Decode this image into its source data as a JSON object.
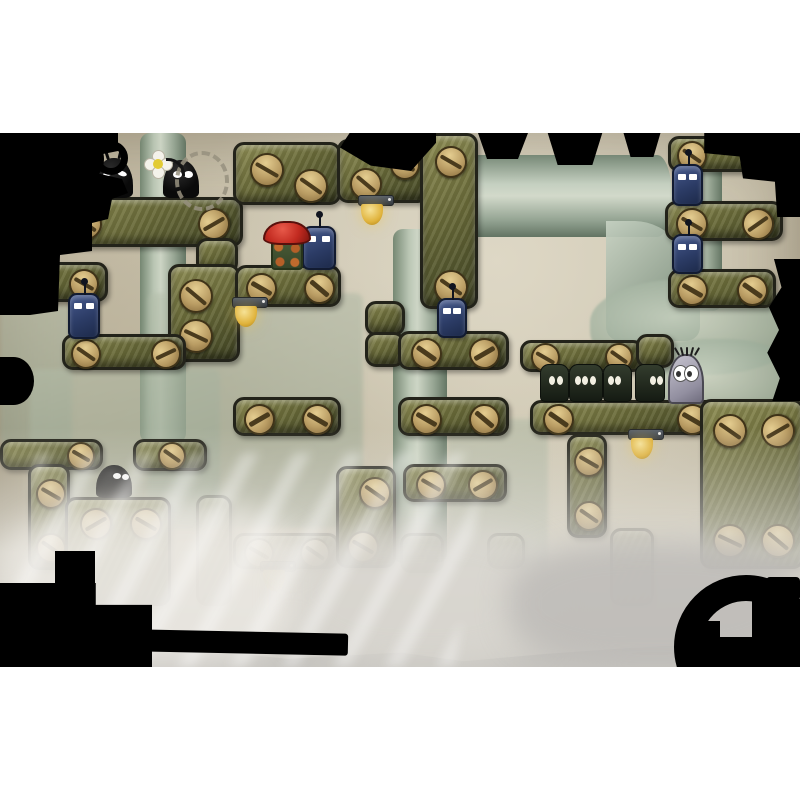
{
  "palette": {
    "paper": "#cbc3ae",
    "paper_light": "#d9d3c0",
    "paper_dark": "#b2a990",
    "plank": "#6b6c3a",
    "plank_border": "#23231a",
    "screw_brass": "#b99c63",
    "pipe": "#a3b1a2",
    "robot_blue": "#2c3c66",
    "creature_black": "#0b0b0b",
    "creature_green": "#222b20",
    "creature_gray": "#aaa7b4",
    "hero_cap_red": "#c52b24",
    "hero_body_green": "#41522f",
    "lamp_yellow": "#e3b93f",
    "ink_black": "#000000",
    "fog": "#e3e1da",
    "letterbox": "#ffffff"
  },
  "viewport": {
    "x": 0,
    "y": 133,
    "width": 800,
    "height": 534
  },
  "pipes": [
    {
      "kind": "v",
      "x": 140,
      "y": 0,
      "w": 46,
      "h": 310
    },
    {
      "kind": "v",
      "x": 393,
      "y": 96,
      "w": 54,
      "h": 334
    },
    {
      "kind": "v",
      "x": 676,
      "y": 28,
      "w": 46,
      "h": 150
    },
    {
      "kind": "h",
      "x": 452,
      "y": 22,
      "w": 220,
      "h": 82
    },
    {
      "kind": "elbow",
      "x": 606,
      "y": 88,
      "w": 94,
      "h": 120
    },
    {
      "kind": "bulge",
      "x": 590,
      "y": 146,
      "w": 210,
      "h": 96
    },
    {
      "kind": "bulge",
      "x": 636,
      "y": 206,
      "w": 164,
      "h": 86
    },
    {
      "kind": "panel",
      "x": 0,
      "y": 172,
      "w": 72,
      "h": 140
    },
    {
      "kind": "panel",
      "x": 30,
      "y": 236,
      "w": 190,
      "h": 160
    },
    {
      "kind": "panel",
      "x": 148,
      "y": 160,
      "w": 215,
      "h": 235
    },
    {
      "kind": "panel",
      "x": 448,
      "y": 286,
      "w": 100,
      "h": 150
    },
    {
      "kind": "collar",
      "x": 134,
      "y": 90,
      "w": 58,
      "h": 18
    },
    {
      "kind": "collar",
      "x": 444,
      "y": 16,
      "w": 20,
      "h": 94
    }
  ],
  "planks": [
    {
      "x": 55,
      "y": 64,
      "w": 182,
      "h": 44,
      "screws": [
        [
          12,
          8,
          28,
          35
        ],
        [
          140,
          8,
          28,
          -30
        ]
      ]
    },
    {
      "x": 196,
      "y": 105,
      "w": 36,
      "h": 30,
      "screws": []
    },
    {
      "x": 168,
      "y": 131,
      "w": 66,
      "h": 92,
      "screws": [
        [
          8,
          12,
          30,
          40
        ],
        [
          8,
          52,
          30,
          25
        ]
      ]
    },
    {
      "x": 233,
      "y": 9,
      "w": 102,
      "h": 57,
      "screws": [
        [
          14,
          8,
          30,
          30
        ],
        [
          58,
          24,
          30,
          35
        ]
      ]
    },
    {
      "x": 337,
      "y": 6,
      "w": 86,
      "h": 58,
      "screws": [
        [
          10,
          26,
          28,
          40
        ],
        [
          50,
          8,
          26,
          30
        ]
      ]
    },
    {
      "x": 420,
      "y": 0,
      "w": 52,
      "h": 170,
      "screws": [
        [
          12,
          10,
          28,
          30
        ],
        [
          11,
          134,
          30,
          35
        ]
      ]
    },
    {
      "x": 10,
      "y": 129,
      "w": 92,
      "h": 34,
      "screws": [
        [
          56,
          4,
          26,
          30
        ]
      ]
    },
    {
      "x": 62,
      "y": 201,
      "w": 118,
      "h": 30,
      "screws": [
        [
          6,
          2,
          26,
          35
        ],
        [
          86,
          2,
          26,
          -25
        ]
      ]
    },
    {
      "x": 235,
      "y": 132,
      "w": 100,
      "h": 36,
      "screws": [
        [
          8,
          5,
          27,
          30
        ],
        [
          66,
          5,
          27,
          40
        ]
      ]
    },
    {
      "x": 365,
      "y": 168,
      "w": 34,
      "h": 29,
      "screws": []
    },
    {
      "x": 365,
      "y": 199,
      "w": 34,
      "h": 29,
      "screws": []
    },
    {
      "x": 398,
      "y": 198,
      "w": 105,
      "h": 33,
      "screws": [
        [
          10,
          4,
          27,
          35
        ],
        [
          68,
          4,
          27,
          -30
        ]
      ]
    },
    {
      "x": 398,
      "y": 264,
      "w": 105,
      "h": 33,
      "screws": [
        [
          10,
          4,
          27,
          30
        ],
        [
          68,
          4,
          27,
          40
        ]
      ]
    },
    {
      "x": 233,
      "y": 264,
      "w": 102,
      "h": 33,
      "screws": [
        [
          8,
          4,
          27,
          -30
        ],
        [
          66,
          4,
          27,
          30
        ]
      ]
    },
    {
      "x": 530,
      "y": 267,
      "w": 182,
      "h": 29,
      "screws": [
        [
          10,
          1,
          27,
          35
        ],
        [
          144,
          1,
          27,
          30
        ]
      ]
    },
    {
      "x": 520,
      "y": 207,
      "w": 118,
      "h": 26,
      "screws": [
        [
          8,
          0,
          25,
          30
        ],
        [
          82,
          0,
          24,
          35
        ]
      ]
    },
    {
      "x": 636,
      "y": 201,
      "w": 32,
      "h": 28,
      "screws": []
    },
    {
      "x": 668,
      "y": 3,
      "w": 112,
      "h": 30,
      "screws": [
        [
          6,
          2,
          26,
          35
        ]
      ]
    },
    {
      "x": 665,
      "y": 68,
      "w": 112,
      "h": 34,
      "screws": [
        [
          8,
          4,
          28,
          30
        ],
        [
          74,
          4,
          28,
          -35
        ]
      ]
    },
    {
      "x": 668,
      "y": 136,
      "w": 102,
      "h": 33,
      "screws": [
        [
          6,
          3,
          27,
          30
        ],
        [
          66,
          3,
          27,
          35
        ]
      ]
    },
    {
      "x": 700,
      "y": 266,
      "w": 98,
      "h": 164,
      "screws": [
        [
          10,
          12,
          30,
          35
        ],
        [
          58,
          12,
          30,
          -30
        ],
        [
          10,
          122,
          30,
          25
        ],
        [
          58,
          122,
          30,
          40
        ]
      ]
    },
    {
      "x": 0,
      "y": 306,
      "w": 97,
      "h": 25,
      "screws": [
        [
          64,
          0,
          24,
          30
        ]
      ]
    },
    {
      "x": 133,
      "y": 306,
      "w": 68,
      "h": 26,
      "screws": [
        [
          22,
          0,
          24,
          35
        ]
      ]
    },
    {
      "x": 28,
      "y": 331,
      "w": 36,
      "h": 100,
      "screws": [
        [
          5,
          12,
          26,
          30
        ],
        [
          5,
          66,
          26,
          35
        ]
      ]
    },
    {
      "x": 65,
      "y": 364,
      "w": 100,
      "h": 103,
      "screws": [
        [
          12,
          8,
          28,
          -30
        ],
        [
          62,
          8,
          28,
          30
        ]
      ]
    },
    {
      "x": 196,
      "y": 362,
      "w": 30,
      "h": 105,
      "screws": [],
      "faded": true
    },
    {
      "x": 233,
      "y": 400,
      "w": 100,
      "h": 30,
      "screws": [
        [
          8,
          2,
          26,
          30
        ],
        [
          64,
          2,
          26,
          35
        ]
      ],
      "faded": true
    },
    {
      "x": 336,
      "y": 333,
      "w": 54,
      "h": 96,
      "screws": [
        [
          20,
          8,
          28,
          35
        ],
        [
          8,
          62,
          28,
          30
        ]
      ]
    },
    {
      "x": 403,
      "y": 331,
      "w": 98,
      "h": 32,
      "screws": [
        [
          10,
          3,
          26,
          30
        ],
        [
          62,
          3,
          26,
          -30
        ]
      ]
    },
    {
      "x": 400,
      "y": 400,
      "w": 38,
      "h": 34,
      "screws": [],
      "faded": true
    },
    {
      "x": 487,
      "y": 400,
      "w": 32,
      "h": 30,
      "screws": [],
      "faded": true
    },
    {
      "x": 567,
      "y": 301,
      "w": 34,
      "h": 98,
      "screws": [
        [
          4,
          10,
          26,
          30
        ],
        [
          4,
          64,
          26,
          35
        ]
      ]
    },
    {
      "x": 610,
      "y": 395,
      "w": 38,
      "h": 72,
      "screws": [],
      "faded": true
    }
  ],
  "lamps": [
    {
      "x": 358,
      "y": 62
    },
    {
      "x": 232,
      "y": 164
    },
    {
      "x": 628,
      "y": 296
    },
    {
      "x": 260,
      "y": 428,
      "faded": true
    }
  ],
  "robots": [
    {
      "x": 302,
      "y": 93,
      "w": 30,
      "h": 40,
      "antenna": true
    },
    {
      "x": 68,
      "y": 160,
      "w": 28,
      "h": 42,
      "antenna": true
    },
    {
      "x": 437,
      "y": 165,
      "w": 26,
      "h": 36,
      "antenna": true
    },
    {
      "x": 672,
      "y": 31,
      "w": 27,
      "h": 38,
      "antenna": true
    },
    {
      "x": 672,
      "y": 101,
      "w": 27,
      "h": 36,
      "antenna": true
    }
  ],
  "creatures": [
    {
      "type": "blob",
      "x": 95,
      "y": 25,
      "w": 38,
      "h": 40,
      "eyes": [
        [
          8,
          13,
          10,
          5,
          -18
        ],
        [
          22,
          13,
          10,
          5,
          18
        ]
      ],
      "hairs": true
    },
    {
      "type": "blob",
      "x": 163,
      "y": 27,
      "w": 36,
      "h": 38,
      "eyes": [
        [
          10,
          11,
          9,
          7,
          0
        ],
        [
          21,
          11,
          9,
          7,
          0
        ]
      ],
      "flower": [
        -19,
        -10
      ],
      "ring": [
        12,
        -9,
        46,
        52
      ]
    },
    {
      "type": "blob",
      "x": 96,
      "y": 332,
      "w": 36,
      "h": 33,
      "eyes": [
        [
          17,
          8,
          8,
          6,
          0
        ],
        [
          26,
          9,
          7,
          6,
          0
        ]
      ]
    },
    {
      "type": "square",
      "x": 540,
      "y": 231,
      "w": 27,
      "h": 36,
      "eyes": [
        [
          8,
          11,
          6,
          9
        ],
        [
          16,
          11,
          6,
          9
        ]
      ]
    },
    {
      "type": "square",
      "x": 569,
      "y": 231,
      "w": 32,
      "h": 36,
      "eyes": [
        [
          5,
          11,
          6,
          9
        ],
        [
          12,
          11,
          6,
          9
        ],
        [
          20,
          11,
          6,
          9
        ]
      ]
    },
    {
      "type": "square",
      "x": 603,
      "y": 231,
      "w": 27,
      "h": 36,
      "eyes": [
        [
          4,
          11,
          6,
          9
        ],
        [
          11,
          11,
          6,
          9
        ]
      ]
    },
    {
      "type": "square",
      "x": 635,
      "y": 231,
      "w": 28,
      "h": 36,
      "eyes": [
        [
          14,
          11,
          6,
          9
        ],
        [
          21,
          11,
          6,
          9
        ]
      ]
    },
    {
      "type": "gray",
      "x": 668,
      "y": 221,
      "w": 32,
      "h": 46
    }
  ],
  "hero": {
    "x": 263,
    "y": 88,
    "cap_w": 44,
    "cap_h": 20,
    "body_x": 8,
    "body_y": 17,
    "body_w": 28,
    "body_h": 28
  }
}
